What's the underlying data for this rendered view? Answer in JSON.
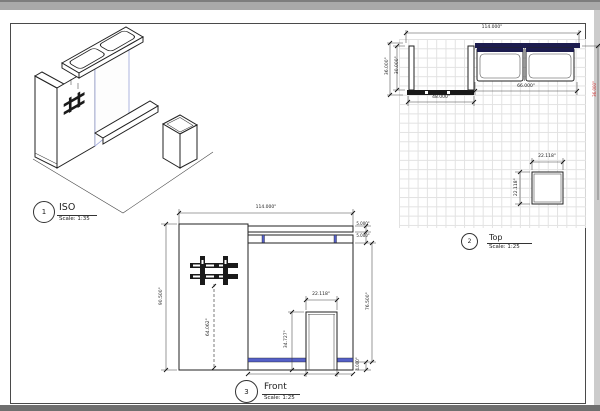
{
  "sheet": {
    "views": [
      {
        "id": "iso",
        "number": "1",
        "title": "ISO",
        "scale": "Scale: 1:35"
      },
      {
        "id": "top",
        "number": "2",
        "title": "Top",
        "scale": "Scale: 1:25"
      },
      {
        "id": "front",
        "number": "3",
        "title": "Front",
        "scale": "Scale: 1:25"
      }
    ]
  },
  "top_view_dims": {
    "overall_width": "114.000\"",
    "depth_outer": "36.000\"",
    "depth_inner": "30.000\"",
    "left_section_width": "48.000\"",
    "counter_run_width": "66.000\"",
    "pedestal_width": "22.118\"",
    "pedestal_depth": "22.118\"",
    "right_edge_dim": "36.000\""
  },
  "front_view_dims": {
    "overall_width": "114.000\"",
    "overall_height": "90.500\"",
    "header_thickness": "5.000\"",
    "header_gap": "5.000\"",
    "wall_body_height": "76.500\"",
    "base_height": "4.000\"",
    "monitor_center_height": "64.062\"",
    "pedestal_width": "22.118\"",
    "pedestal_height": "34.727\""
  },
  "colors": {
    "accent_blue": "#5560c8",
    "counter_top_navy": "#1c1c4e",
    "wall_fill": "#1a1a1a",
    "grid_line": "#e2e2e2",
    "red_dim": "#cc2a2a"
  }
}
